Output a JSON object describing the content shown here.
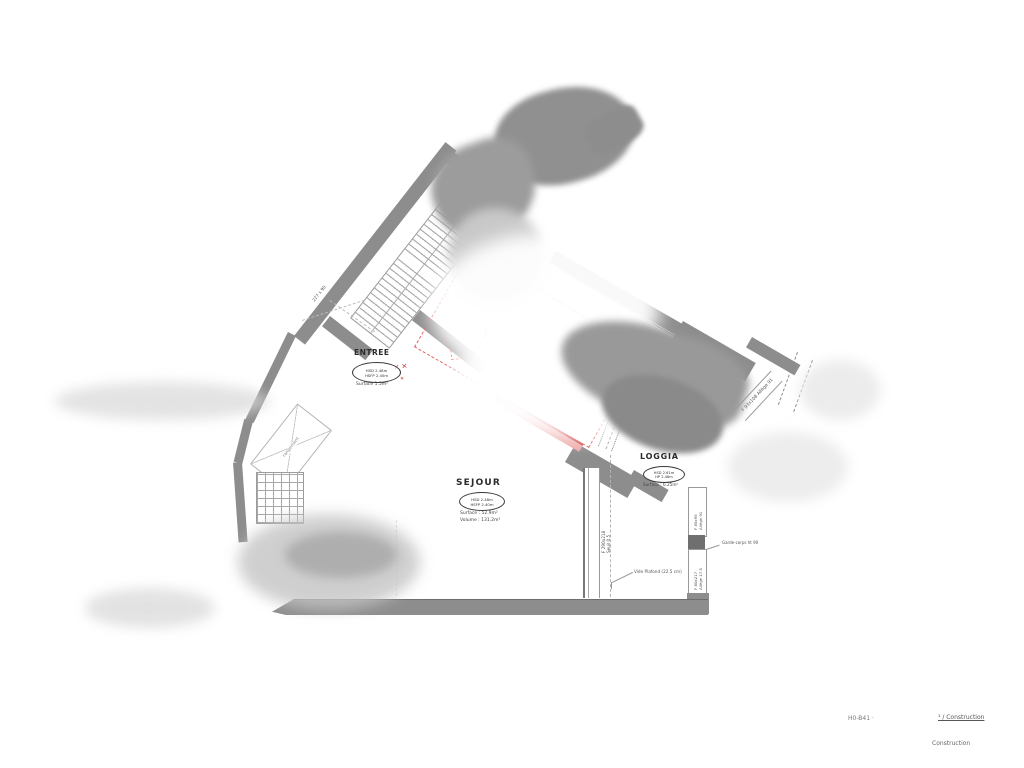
{
  "plan": {
    "rooms": {
      "entree": {
        "name": "ENTREE",
        "hsd": "HSD 2.48m",
        "hsfp": "HSFP 2.40m",
        "surface": "Surface 1.5m²"
      },
      "sejour": {
        "name": "SEJOUR",
        "hsd": "HSD 2.48m",
        "hsfp": "HSFP 2.40m",
        "surface": "Surface : 52.9m²",
        "volume": "Volume : 131.2m³"
      },
      "loggia": {
        "name": "LOGGIA",
        "hsd": "HSD 2.61m",
        "hsfp": "HP 2.48m",
        "surface": "Surface : 6.25m²"
      }
    },
    "openings": {
      "right_top": "F 93x108  Allège 91",
      "sejour_diag_l1": "F 250x218",
      "sejour_diag_l2": "Seuil 0.5",
      "sejour_vert_l1": "F 290x218",
      "sejour_vert_l2": "Seuil 0.5",
      "loggia_right_top_l1": "F 85x95",
      "loggia_right_top_l2": "Allège 91",
      "loggia_right_bottom_l1": "F 80x217",
      "loggia_right_bottom_l2": "Allège 17.5"
    },
    "annotations": {
      "vide_plafond": "Vide Plafond (22.5 cm)",
      "garde_corps": "Garde-corps ht 90",
      "closet": "rangement",
      "corridor_dim": "227 x 90",
      "red_marks": "✕ ✕",
      "red_mark_small": "✕"
    },
    "footer": {
      "ref": "H0-B41 ·",
      "link": "¹ / Construction",
      "line2": "Construction"
    }
  }
}
